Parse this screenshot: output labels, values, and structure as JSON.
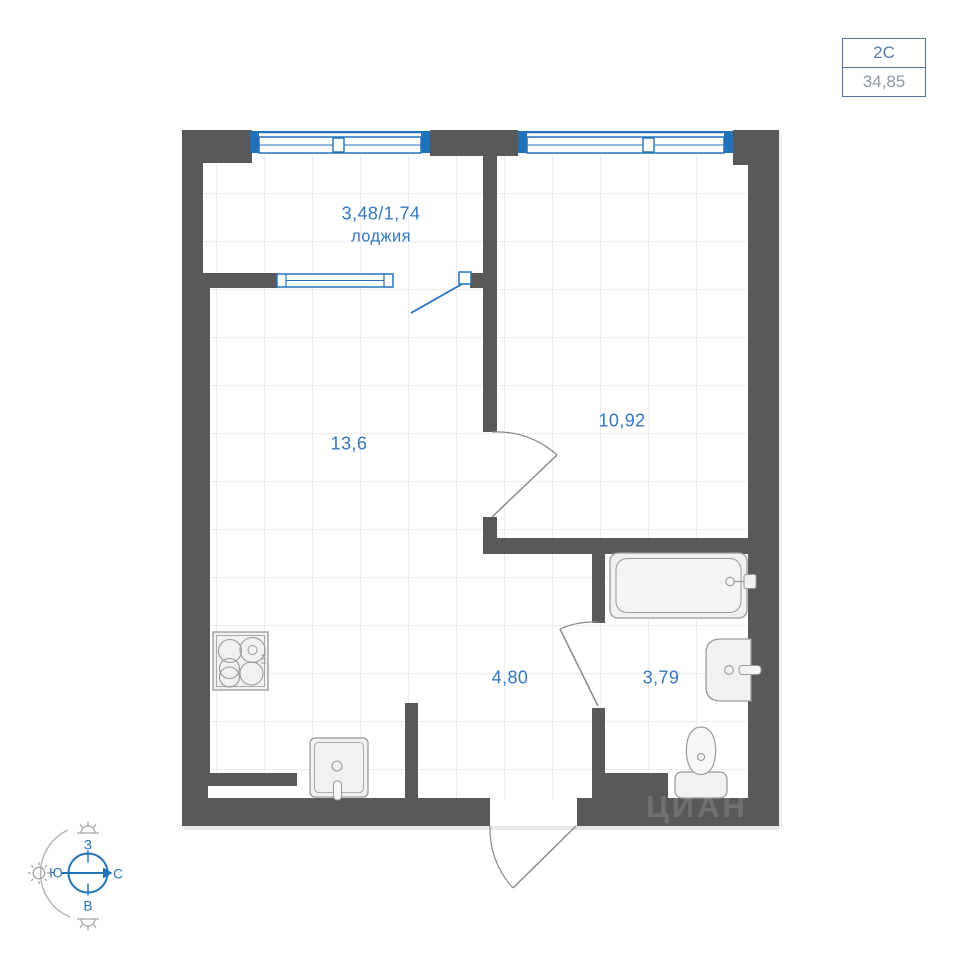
{
  "unit_card": {
    "type_label": "2С",
    "area_value": "34,85"
  },
  "labels": {
    "loggia_area": "3,48/1,74",
    "loggia_name": "лоджия",
    "living_area": "13,6",
    "bedroom_area": "10,92",
    "hall_area": "4,80",
    "bathroom_area": "3,79"
  },
  "compass": {
    "top": "З",
    "left": "Ю",
    "right": "С",
    "bottom": "В"
  },
  "watermark_text": "ЦИАН",
  "colors": {
    "wall": "#59595b",
    "window_blue": "#2272bb",
    "label_blue": "#3478c2",
    "door_gray": "#8d8a86",
    "fixture_stroke": "#9a9896",
    "fixture_fill": "#f1f1ef",
    "grid_line": "#e9edf3",
    "card_border": "#54719e",
    "card_type_text": "#5b79a5",
    "card_area_text": "#8f9aa7",
    "compass_gray": "#a5a3a0"
  }
}
